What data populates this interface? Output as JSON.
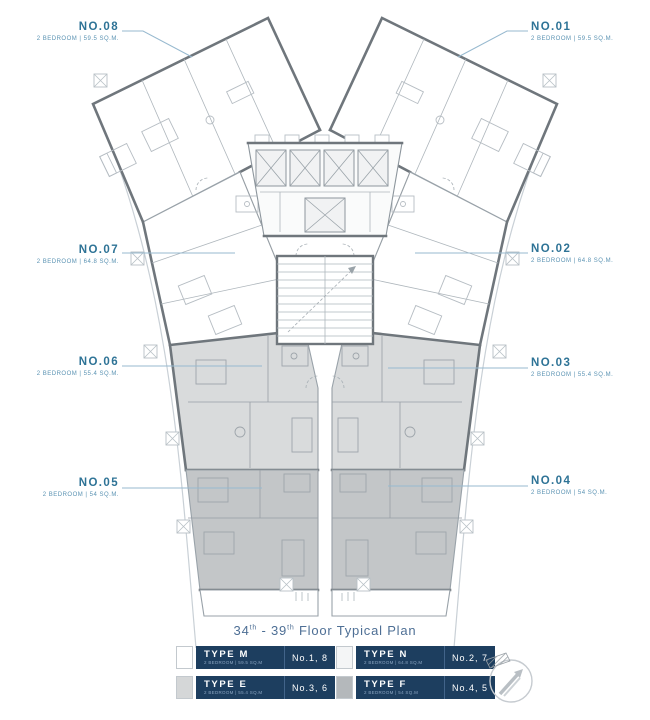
{
  "plan": {
    "title": {
      "floor_start": "34",
      "floor_start_sup": "th",
      "separator": " - ",
      "floor_end": "39",
      "floor_end_sup": "th",
      "suffix": " Floor Typical Plan"
    },
    "units": [
      {
        "id": "NO.08",
        "spec": "2 BEDROOM | 59.5 SQ.M.",
        "position": "top-left"
      },
      {
        "id": "NO.01",
        "spec": "2 BEDROOM | 59.5 SQ.M.",
        "position": "top-right"
      },
      {
        "id": "NO.07",
        "spec": "2 BEDROOM | 64.8 SQ.M.",
        "position": "left"
      },
      {
        "id": "NO.02",
        "spec": "2 BEDROOM | 64.8 SQ.M.",
        "position": "right"
      },
      {
        "id": "NO.06",
        "spec": "2 BEDROOM | 55.4 SQ.M.",
        "position": "left"
      },
      {
        "id": "NO.03",
        "spec": "2 BEDROOM | 55.4 SQ.M.",
        "position": "right"
      },
      {
        "id": "NO.05",
        "spec": "2 BEDROOM | 54 SQ.M.",
        "position": "left"
      },
      {
        "id": "NO.04",
        "spec": "2 BEDROOM | 54 SQ.M.",
        "position": "right"
      }
    ],
    "colors": {
      "label_number": "#2e7396",
      "label_spec": "#5b93b3",
      "title": "#4e6f95",
      "legend_bg": "#1d3e5f",
      "unit_white": "#ffffff",
      "unit_light_gray": "#d9dbdc",
      "unit_dark_gray": "#c3c6c8",
      "wall": "#6f767c"
    }
  },
  "legend": {
    "items": [
      {
        "type": "TYPE M",
        "spec": "2 BEDROOM | 59.5 SQ.M",
        "units": "No.1, 8",
        "swatch": "#ffffff"
      },
      {
        "type": "TYPE N",
        "spec": "2 BEDROOM | 64.8 SQ.M",
        "units": "No.2, 7",
        "swatch": "#f4f5f6"
      },
      {
        "type": "TYPE E",
        "spec": "2 BEDROOM | 55.4 SQ.M",
        "units": "No.3, 6",
        "swatch": "#d5d7d8"
      },
      {
        "type": "TYPE F",
        "spec": "2 BEDROOM | 54 SQ.M",
        "units": "No.4, 5",
        "swatch": "#b4b8bb"
      }
    ]
  },
  "compass": {
    "name": "north-arrow"
  }
}
